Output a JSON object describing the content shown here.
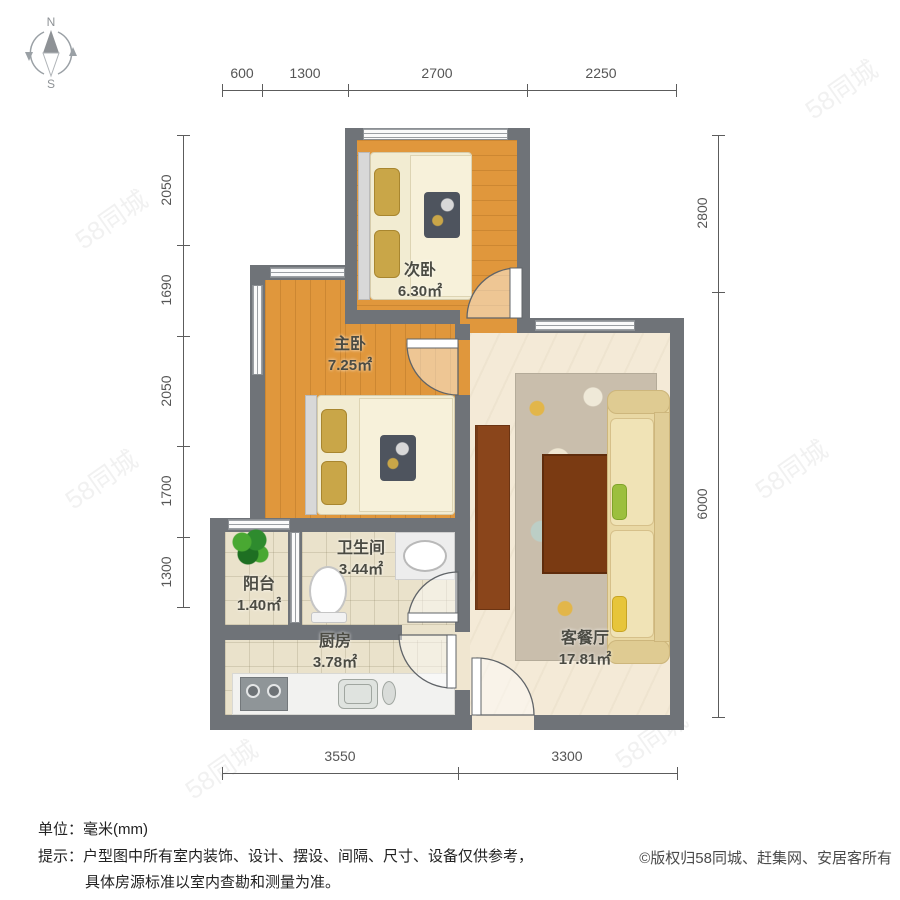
{
  "compass": {
    "north_label": "N",
    "south_label": "S"
  },
  "dimensions": {
    "unit": "mm",
    "top": [
      "600",
      "1300",
      "2700",
      "2250"
    ],
    "left": [
      "2050",
      "1690",
      "2050",
      "1700",
      "1300"
    ],
    "right": [
      "2800",
      "6000"
    ],
    "bottom": [
      "3550",
      "3300"
    ]
  },
  "rooms": {
    "second_bedroom": {
      "name": "次卧",
      "area": "6.30㎡"
    },
    "master_bedroom": {
      "name": "主卧",
      "area": "7.25㎡"
    },
    "bathroom": {
      "name": "卫生间",
      "area": "3.44㎡"
    },
    "balcony": {
      "name": "阳台",
      "area": "1.40㎡"
    },
    "kitchen": {
      "name": "厨房",
      "area": "3.78㎡"
    },
    "living_dining": {
      "name": "客餐厅",
      "area": "17.81㎡"
    }
  },
  "footer": {
    "unit_line": "单位：毫米(mm)",
    "tip_prefix": "提示：",
    "tip_line1": "户型图中所有室内装饰、设计、摆设、间隔、尺寸、设备仅供参考，",
    "tip_line2": "具体房源标准以室内查勘和测量为准。",
    "copyright": "©版权归58同城、赶集网、安居客所有"
  },
  "watermark": {
    "text": "58同城"
  },
  "colors": {
    "wall": "#6f7378",
    "wood_floor": "#e0973c",
    "tile_floor": "#eae2cb",
    "living_floor": "#f4ead7",
    "bed_cream": "#f2ecd2",
    "pillow_gold": "#c9a648",
    "sofa": "#e9d8a4",
    "coffee_table": "#7a3a12",
    "tv_cabinet": "#8a451b",
    "plant_green": "#2e8b2e",
    "pillow_green": "#9cbf3e",
    "pillow_yellow": "#e7c53a"
  }
}
